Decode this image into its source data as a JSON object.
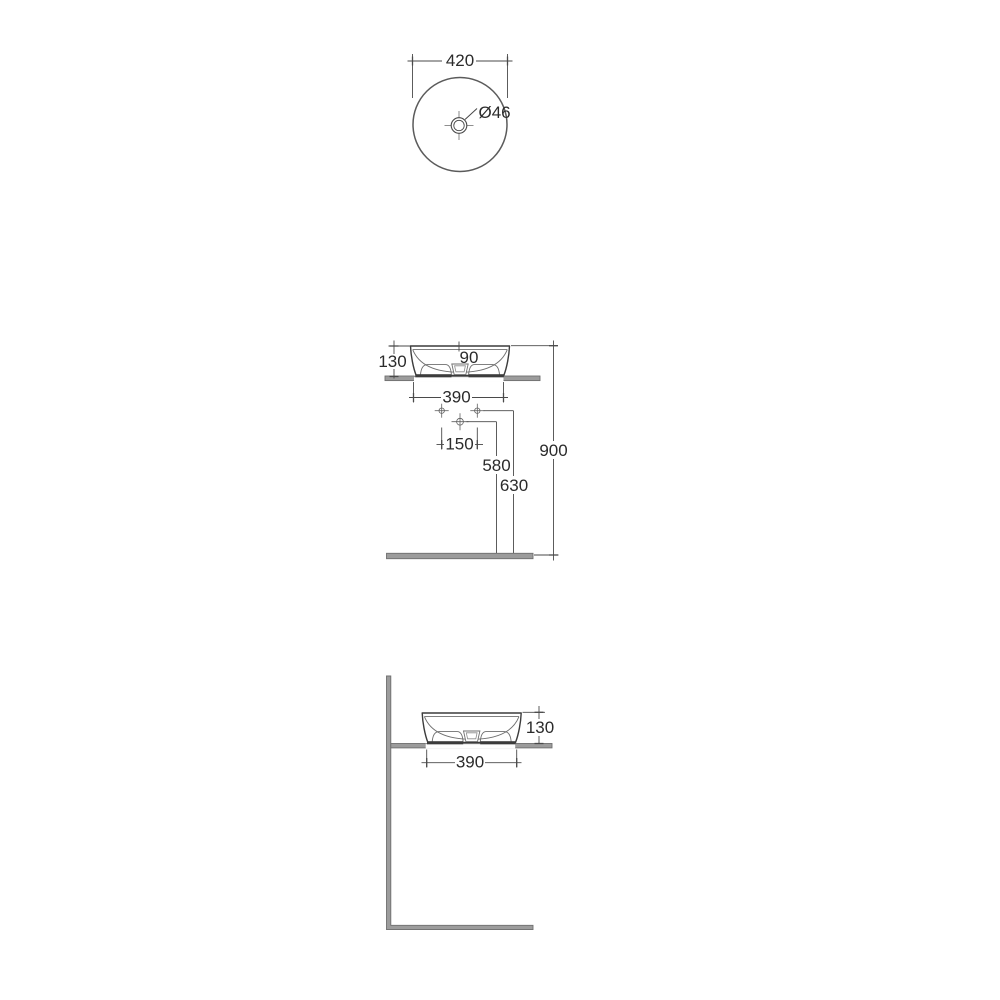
{
  "top_view": {
    "diameter": "420",
    "drain": "Ø46"
  },
  "front_view": {
    "height": "130",
    "center_offset": "90",
    "base_width": "390",
    "hole_spacing": "150",
    "drain_height": "580",
    "holes_height": "630",
    "rim_height": "900"
  },
  "side_view": {
    "height": "130",
    "base_width": "390"
  },
  "colors": {
    "outline": "#3c3c3c",
    "dimension_line": "#4a4a4a",
    "detail_line": "#6e6e6e",
    "surface_fill": "#9c9c9c",
    "surface_edge": "#6f6f6f",
    "text": "#2b2b2b",
    "background": "#ffffff"
  }
}
